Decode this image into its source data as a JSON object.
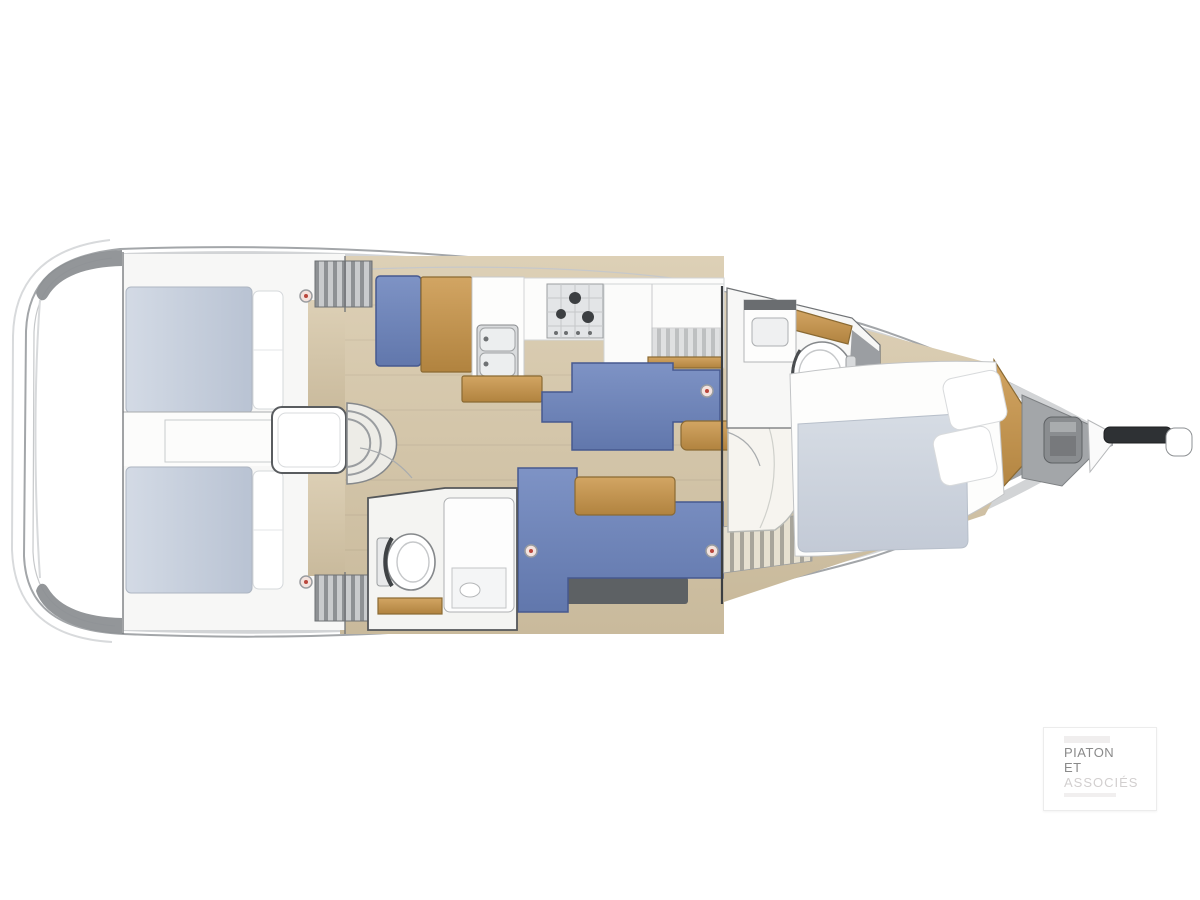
{
  "watermark": {
    "line1": "PIATON",
    "line2": "ET",
    "line3": "ASSOCIÉS"
  },
  "areas": {
    "hull": "Sailboat hull deck plan, bow to the right",
    "swim_platform": "Transom and swim platform",
    "aft_cabin_port": "Aft double cabin (top)",
    "aft_cabin_starboard": "Aft double cabin (bottom)",
    "engine_corridor": "Engine compartment under cockpit",
    "companionway": "Companionway steps",
    "nav_station": "Chart table with seat",
    "galley": "Galley with double sink, stove and fridge",
    "saloon": "Saloon with two settees and tables",
    "aft_head": "Aft head with toilet and shower",
    "forward_head": "Forward head with toilet and vanity",
    "forward_cabin": "Forward cabin with island double bed",
    "anchor_locker": "Anchor locker with windlass",
    "bowsprit": "Bowsprit and anchor roller"
  },
  "colors": {
    "hull_stroke": "#a3a6a9",
    "deck_light": "#d2d4d6",
    "deck_dark": "#8d9094",
    "floor_light": "#ddd0b6",
    "floor_dark": "#c9ba9c",
    "wood_light": "#d2a563",
    "wood_dark": "#b1833f",
    "settee_light": "#7e93c5",
    "settee_dark": "#6177ac",
    "settee_stroke": "#46598f",
    "mattress_light": "#d3dae5",
    "mattress_dark": "#b9c3d3",
    "blanket_light": "#d6dce4",
    "blanket_dark": "#c3cad6",
    "wall_gray": "#9b9ea2",
    "locker_gray": "#a3a6a9",
    "fitting_dark": "#2e3134",
    "side_band_dark": "#5d6164",
    "hatch_red": "#b9463c",
    "white_furniture": "#fdfdfc"
  }
}
